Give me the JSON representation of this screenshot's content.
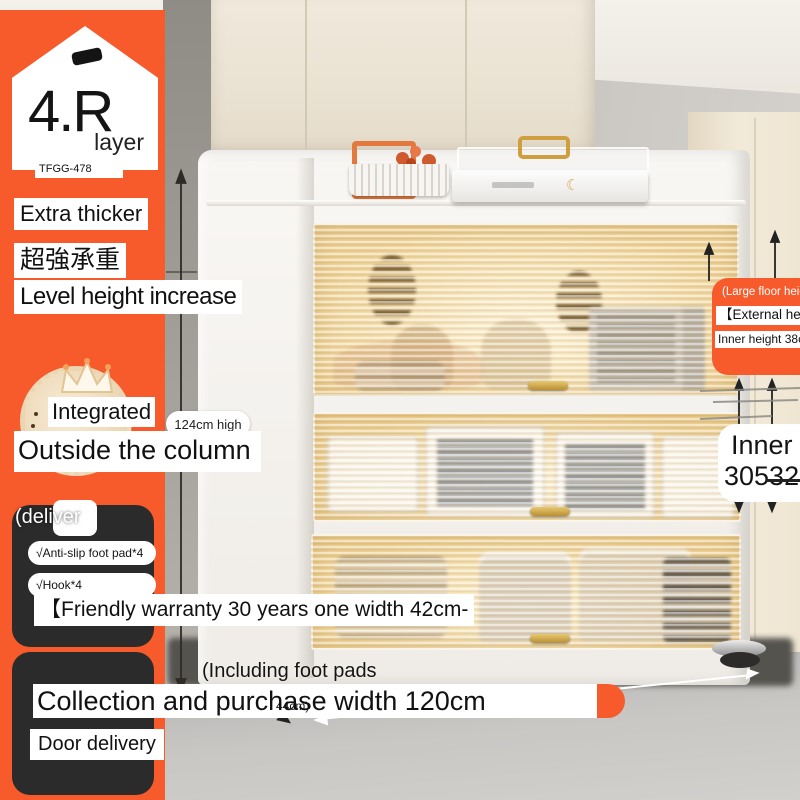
{
  "colors": {
    "accent": "#f75b2c",
    "dark_box": "#2b2b2b",
    "glass_glow": "#f2dca8"
  },
  "badge": {
    "number": "4.R",
    "unit": "layer",
    "model": "TFGG-478"
  },
  "left": {
    "feature1": "Extra thicker",
    "feature2": "超強承重",
    "feature3": "Level height increase",
    "integrated": "Integrated",
    "height_pill": "124cm high",
    "outside": "Outside the column",
    "deliver_title": "(deliver",
    "deliver_item1": "√Anti-slip foot pad*4",
    "deliver_item2": "√Hook*4",
    "warranty": "【Friendly warranty 30 years one width 42cm-",
    "including": "(Including foot pads",
    "collection": "Collection and purchase width 120cm",
    "depth": "44cm)",
    "door_delivery": "Door delivery"
  },
  "right": {
    "large_floor": "(Large floor heigh",
    "external": "【External height 4",
    "inner38": "Inner height 38cm",
    "inner_cut1": "Inner h",
    "inner_cut2": "30532"
  },
  "icons": {
    "moon": "☾"
  }
}
